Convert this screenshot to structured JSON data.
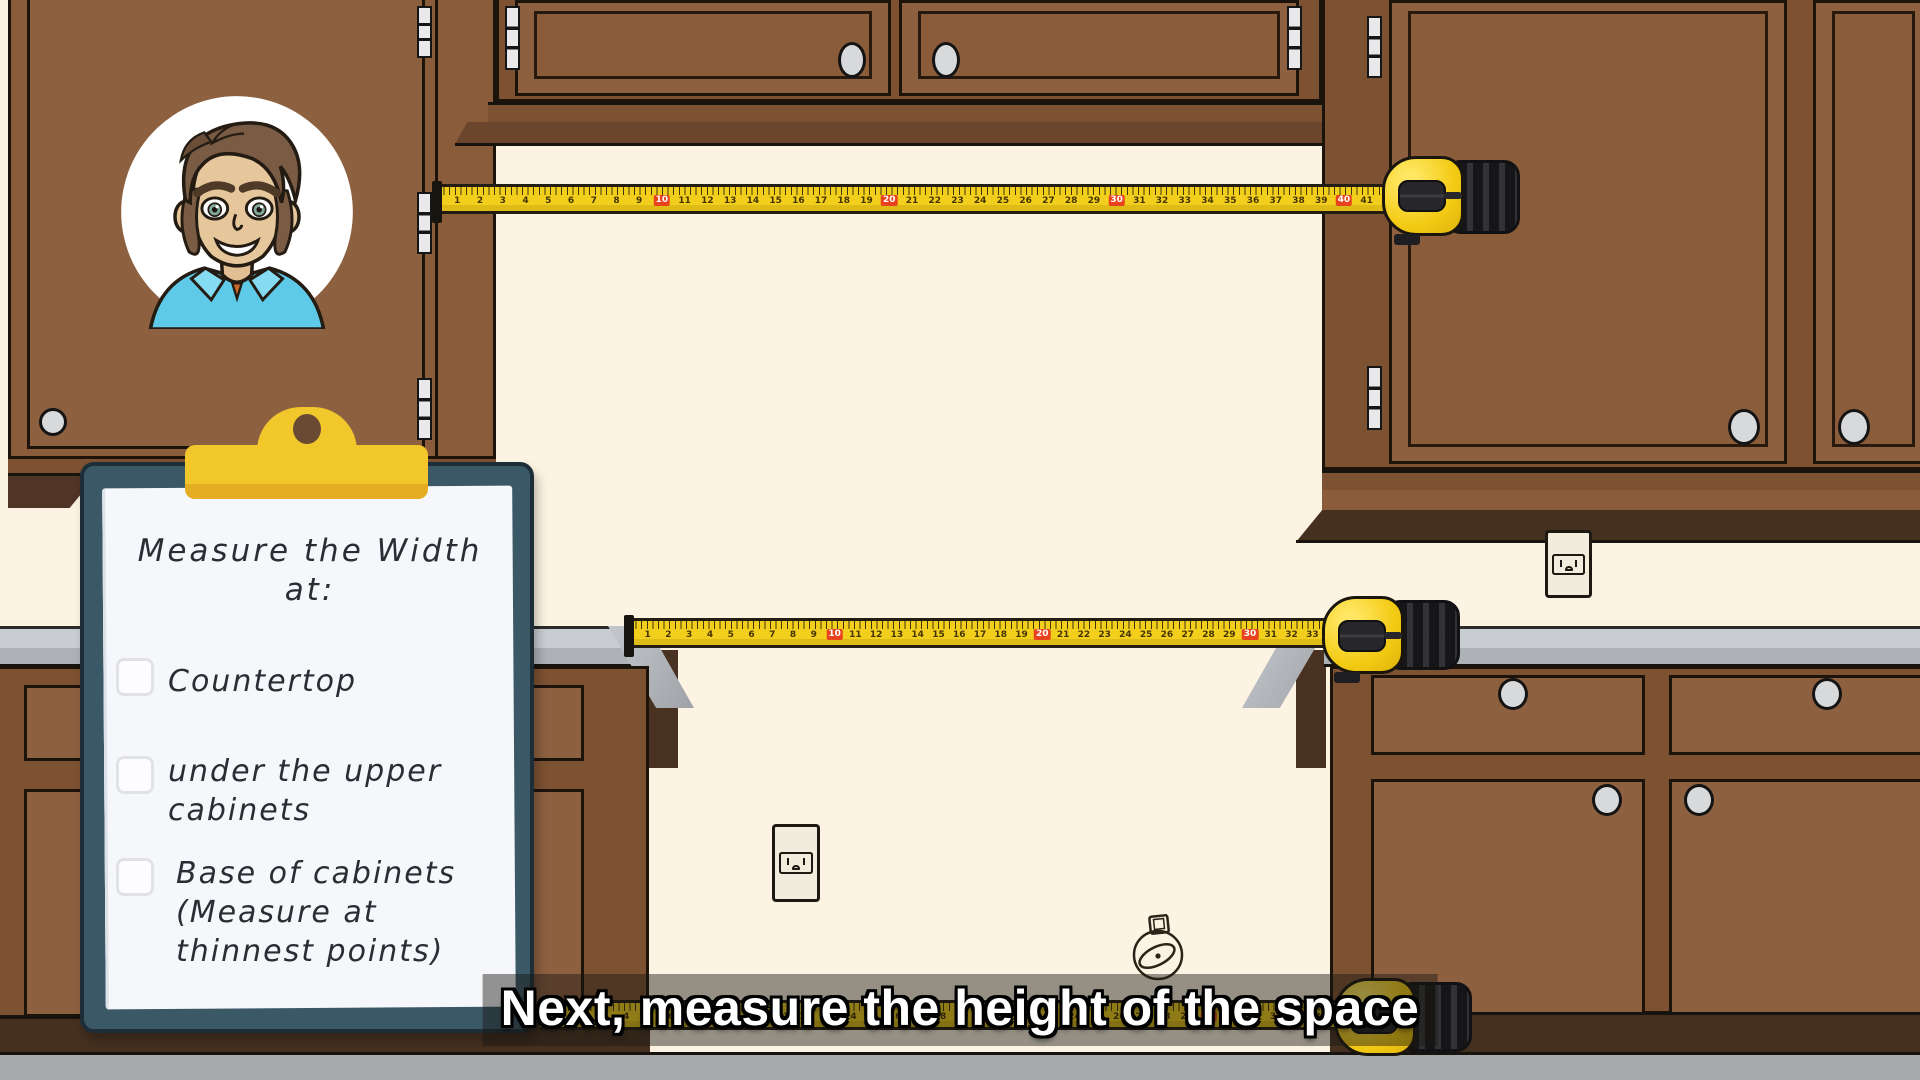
{
  "caption": {
    "text": "Next, measure the height of the space"
  },
  "clipboard": {
    "title": "Measure the Width\nat:",
    "items": [
      {
        "label": "Countertop",
        "checked": false
      },
      {
        "label": "under the upper\ncabinets",
        "checked": false
      },
      {
        "label": "Base of cabinets\n(Measure at\nthinnest points)",
        "checked": false
      }
    ]
  },
  "tapes": {
    "top": {
      "numbers": [
        1,
        2,
        3,
        4,
        5,
        6,
        7,
        8,
        9,
        10,
        11,
        12,
        13,
        14,
        15,
        16,
        17,
        18,
        19,
        20,
        21,
        22,
        23,
        24,
        25,
        26,
        27,
        28,
        29,
        30,
        31,
        32,
        33,
        34,
        35,
        36,
        37,
        38,
        39,
        40,
        41
      ],
      "red_every": 10
    },
    "middle": {
      "numbers": [
        1,
        2,
        3,
        4,
        5,
        6,
        7,
        8,
        9,
        10,
        11,
        12,
        13,
        14,
        15,
        16,
        17,
        18,
        19,
        20,
        21,
        22,
        23,
        24,
        25,
        26,
        27,
        28,
        29,
        30,
        31,
        32,
        33
      ],
      "red_every": 10
    },
    "bottom": {
      "numbers": [
        1,
        2,
        3,
        4,
        5,
        6,
        7,
        8,
        9,
        10,
        11,
        12,
        13,
        14,
        15,
        16,
        17,
        18,
        19,
        20,
        21,
        22,
        23,
        24,
        25,
        26,
        27,
        28,
        29,
        30,
        31,
        32,
        33,
        34,
        35
      ],
      "red_every": 10
    }
  },
  "colors": {
    "wall": "#fcf3e2",
    "cabinet_frame": "#7d5233",
    "cabinet_door": "#8d6040",
    "cabinet_trim_dark": "#45301f",
    "countertop_gray": "#c9cdd1",
    "floor_gray": "#a7a9ab",
    "tape_yellow": "#f2cf1d",
    "tape_red_mark": "#e8431e",
    "clipboard_board": "#3a5866",
    "clip_yellow": "#f1c72c",
    "caption_text": "#ffffff"
  },
  "icons": {
    "avatar": "presenter-cartoon-man",
    "clip": "clipboard-clip",
    "tape": "tape-measure",
    "outlet": "duplex-power-outlet",
    "fixture": "wall-light-fixture"
  }
}
